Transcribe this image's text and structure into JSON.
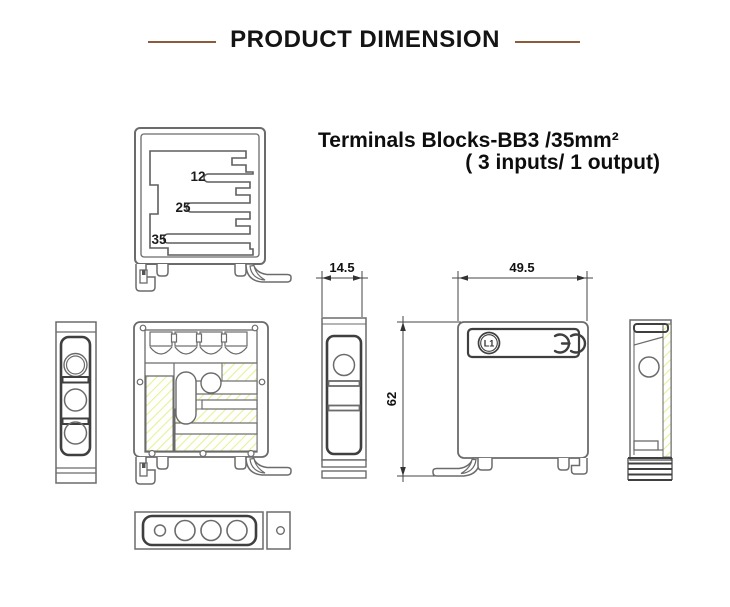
{
  "header": {
    "title": "PRODUCT DIMENSION"
  },
  "product": {
    "title_line1": "Terminals Blocks-BB3 /35mm²",
    "title_line2": "( 3 inputs/ 1 output)"
  },
  "profile": {
    "slot_labels": [
      "12",
      "25",
      "35"
    ]
  },
  "dimensions": {
    "side_width": "14.5",
    "front_width": "49.5",
    "height": "62"
  },
  "markings": {
    "circuit_label": "L1",
    "ce_mark": "CE"
  },
  "colors": {
    "accent_rule": "#8a5c3c",
    "drawing_line": "#666666",
    "drawing_dark": "#3f3f3f",
    "hatch_yellow": "#e7f191"
  }
}
